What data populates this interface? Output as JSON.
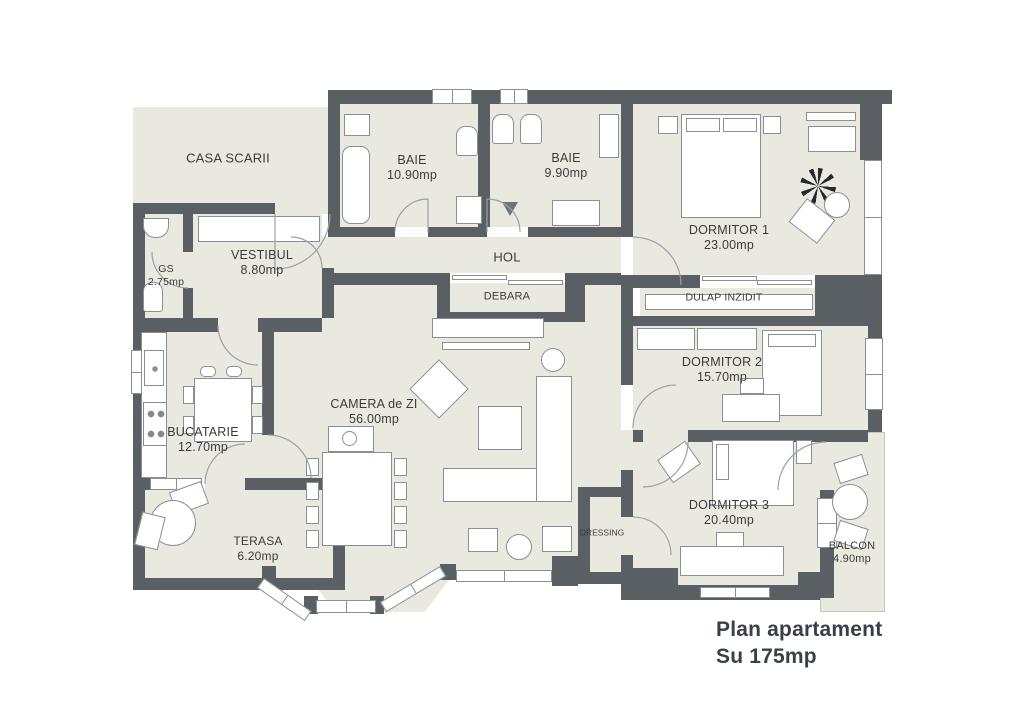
{
  "plan": {
    "title_line1": "Plan apartament",
    "title_line2": "Su 175mp"
  },
  "rooms": [
    {
      "name": "CASA SCARII",
      "area": ""
    },
    {
      "name": "BAIE",
      "area": "10.90mp"
    },
    {
      "name": "BAIE",
      "area": "9.90mp"
    },
    {
      "name": "DORMITOR 1",
      "area": "23.00mp"
    },
    {
      "name": "VESTIBUL",
      "area": "8.80mp"
    },
    {
      "name": "GS",
      "area": "2.75mp"
    },
    {
      "name": "HOL",
      "area": ""
    },
    {
      "name": "DEBARA",
      "area": ""
    },
    {
      "name": "DULAP INZIDIT",
      "area": ""
    },
    {
      "name": "DORMITOR 2",
      "area": "15.70mp"
    },
    {
      "name": "BUCATARIE",
      "area": "12.70mp"
    },
    {
      "name": "CAMERA de ZI",
      "area": "56.00mp"
    },
    {
      "name": "TERASA",
      "area": "6.20mp"
    },
    {
      "name": "DRESSING",
      "area": ""
    },
    {
      "name": "DORMITOR 3",
      "area": "20.40mp"
    },
    {
      "name": "BALCON",
      "area": "4.90mp"
    }
  ],
  "colors": {
    "wall": "#5a5f64",
    "floor": "#e9e9e0",
    "background": "#ffffff",
    "furniture_outline": "#8a8f94",
    "label_text": "#3b3b3b",
    "title_text": "#3a4047"
  }
}
